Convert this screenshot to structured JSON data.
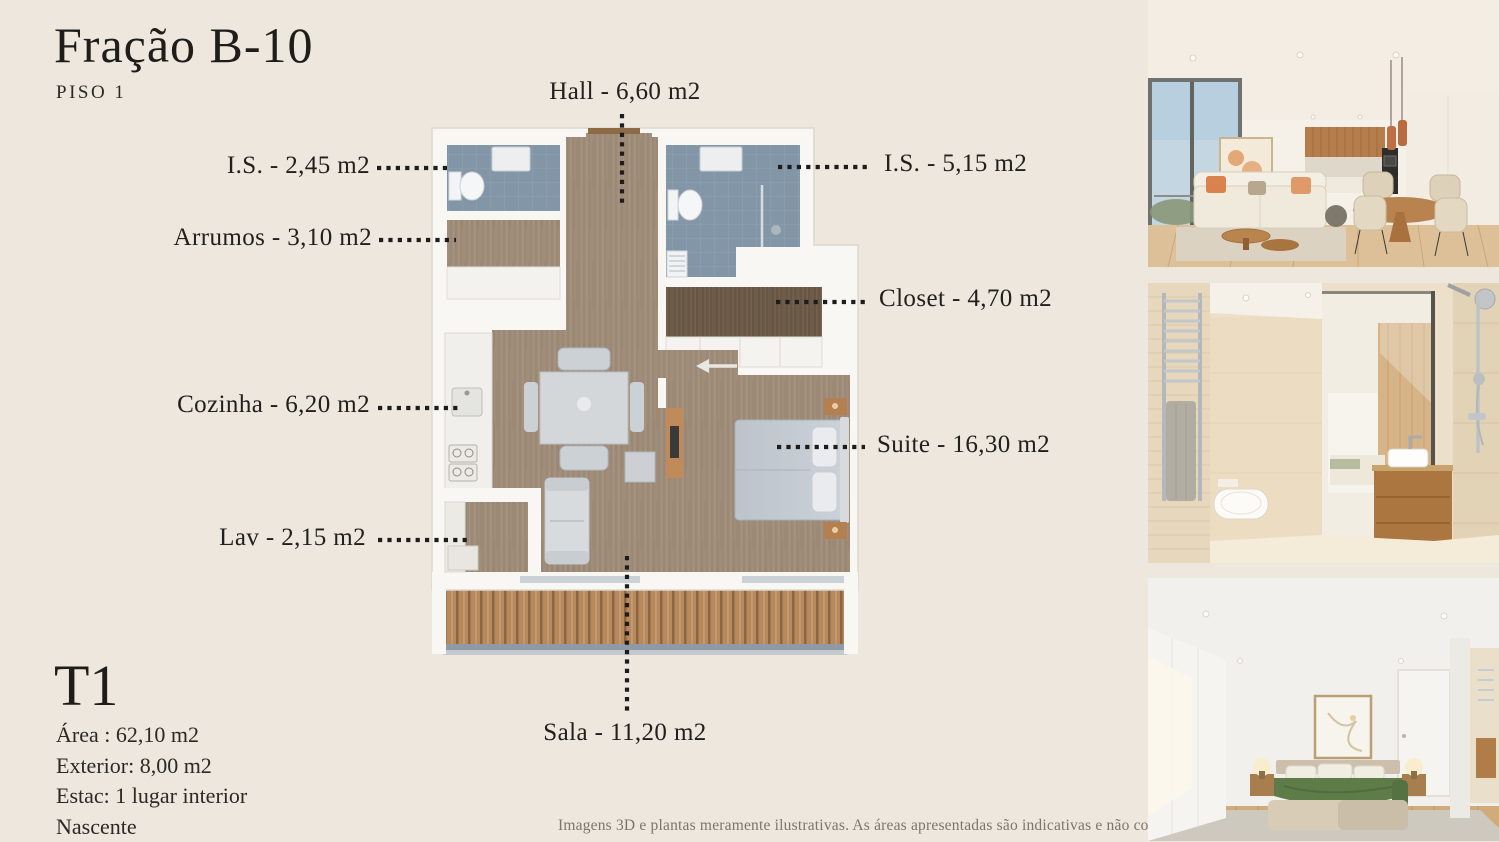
{
  "page": {
    "title": "Fração B-10",
    "subtitle": "PISO 1",
    "disclaimer": "Imagens 3D e plantas meramente ilustrativas. As áreas apresentadas são indicativas e não contratuais."
  },
  "unit_info": {
    "typology": "T1",
    "area": "Área : 62,10 m2",
    "exterior": "Exterior: 8,00 m2",
    "parking": "Estac: 1 lugar interior",
    "orientation": "Nascente"
  },
  "floorplan": {
    "labels": {
      "hall": "Hall - 6,60 m2",
      "is_left": "I.S. - 2,45 m2",
      "arrumos": "Arrumos - 3,10 m2",
      "cozinha": "Cozinha - 6,20 m2",
      "lav": "Lav - 2,15 m2",
      "is_right": "I.S. - 5,15 m2",
      "closet": "Closet - 4,70 m2",
      "suite": "Suite - 16,30 m2",
      "sala": "Sala - 11,20 m2"
    }
  },
  "photos": [
    {
      "name": "living-room-render"
    },
    {
      "name": "bathroom-render"
    },
    {
      "name": "bedroom-render"
    }
  ],
  "colors": {
    "background": "#EDE7DD",
    "text": "#21201D",
    "wood_floor": "#A08D7A",
    "dark_wood": "#6E5C4A",
    "bathroom_tile": "#8296A8",
    "balcony_wood": "#B68A5E",
    "leader_line": "#1D1C1A",
    "disclaimer_text": "#7C766A"
  }
}
